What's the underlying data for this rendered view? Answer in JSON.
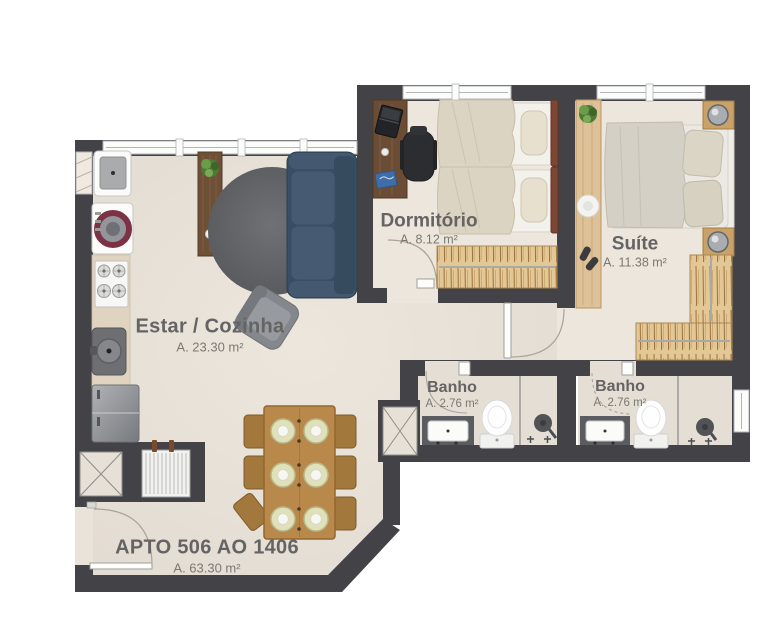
{
  "apartment": {
    "name": "APTO 506 AO 1406",
    "area": "A. 63.30 m²"
  },
  "rooms": {
    "estar": {
      "name": "Estar / Cozinha",
      "area": "A. 23.30 m²"
    },
    "dormitorio": {
      "name": "Dormitório",
      "area": "A. 8.12 m²"
    },
    "suite": {
      "name": "Suíte",
      "area": "A. 11.38 m²"
    },
    "banho1": {
      "name": "Banho",
      "area": "A. 2.76 m²"
    },
    "banho2": {
      "name": "Banho",
      "area": "A. 2.76 m²"
    }
  },
  "colors": {
    "wall": "#434347",
    "floor_living": "#e9e3da",
    "floor_bedroom": "#ece6dc",
    "floor_bath": "#e4ded5",
    "sofa": "#3a4e63",
    "rug": "#606266",
    "wood_dark": "#6e5037",
    "wood_oak": "#b8894a",
    "wardrobe_tan": "#e3c795",
    "washer_ring": "#7c3145",
    "label_text": "#646464"
  }
}
